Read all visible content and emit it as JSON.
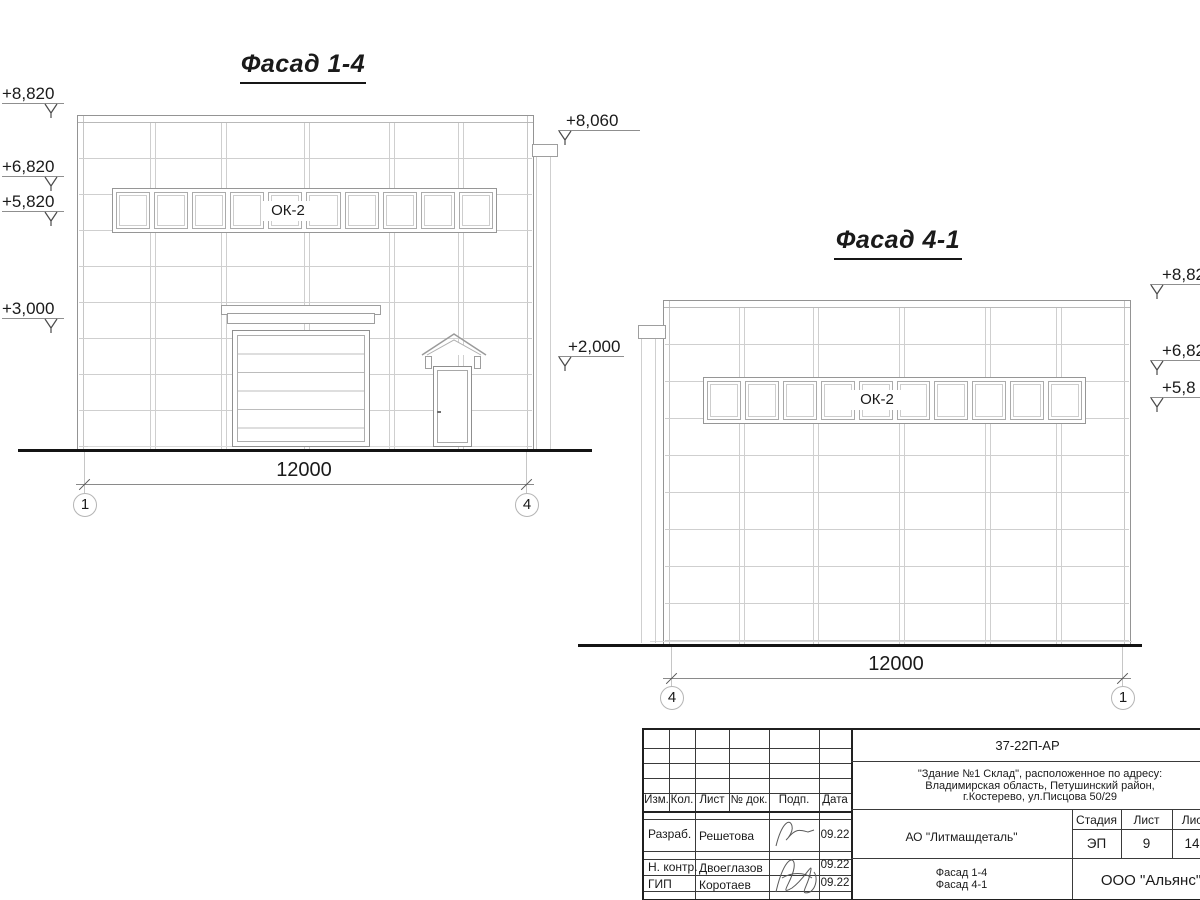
{
  "facade14": {
    "title": "Фасад 1-4",
    "window_label": "ОК-2",
    "dimension": "12000",
    "axis_left": "1",
    "axis_right": "4",
    "marks_left": [
      "+8,820",
      "+6,820",
      "+5,820",
      "+3,000"
    ],
    "marks_right": [
      "+8,060",
      "+2,000"
    ]
  },
  "facade41": {
    "title": "Фасад 4-1",
    "window_label": "ОК-2",
    "dimension": "12000",
    "axis_left": "4",
    "axis_right": "1",
    "marks_right": [
      "+8,82",
      "+6,82",
      "+5,8"
    ]
  },
  "titleblock": {
    "doc_code": "37-22П-АР",
    "address": [
      "\"Здание №1 Склад\", расположенное по адресу:",
      "Владимирская область, Петушинский район,",
      "г.Костерево, ул.Писцова 50/29"
    ],
    "columns": {
      "izm": "Изм.",
      "kol": "Кол.",
      "list": "Лист",
      "doc": "№ док.",
      "podp": "Подп.",
      "data": "Дата"
    },
    "rows": [
      {
        "role": "Разраб.",
        "name": "Решетова",
        "date": "09.22"
      },
      {
        "role": "Н. контр.",
        "name": "Двоеглазов",
        "date": "09.22"
      },
      {
        "role": "ГИП",
        "name": "Коротаев",
        "date": "09.22"
      }
    ],
    "org": "АО \"Литмашдеталь\"",
    "stage_label": "Стадия",
    "sheet_label": "Лист",
    "sheets_label": "Лис",
    "stage": "ЭП",
    "sheet": "9",
    "sheets": "14",
    "sheet_title": [
      "Фасад 1-4",
      "Фасад 4-1"
    ],
    "company": "ООО \"Альянс\""
  },
  "colors": {
    "ink": "#1a1a1a",
    "outline": "#949494",
    "panel_line": "#cfcfcf"
  }
}
